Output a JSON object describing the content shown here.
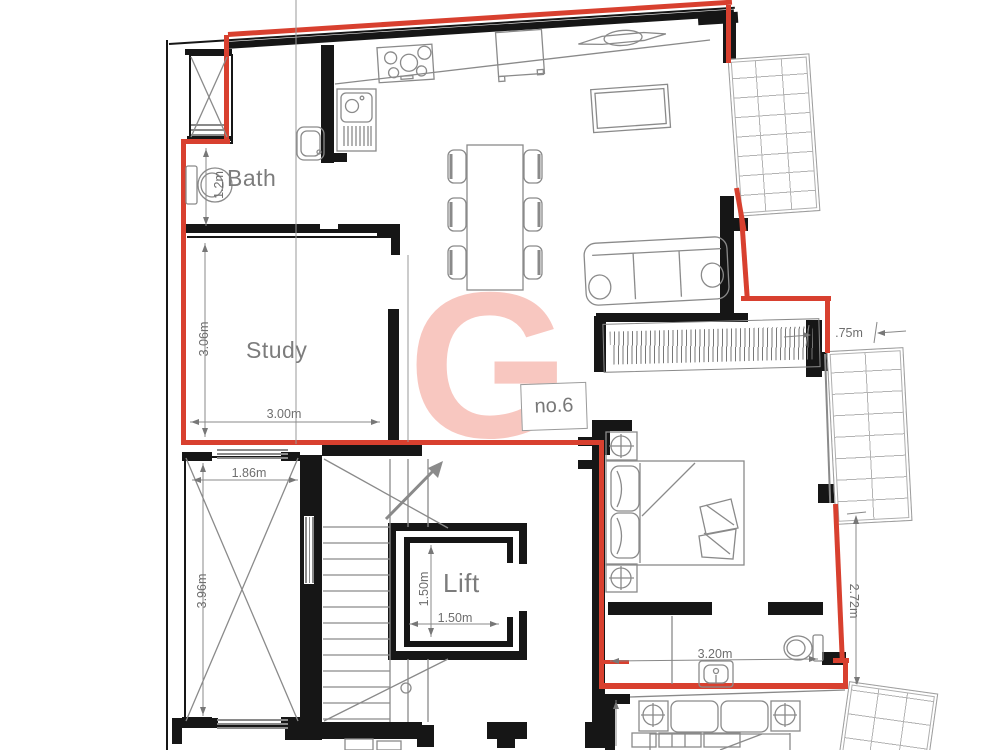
{
  "document": {
    "type": "architectural-floor-plan",
    "unit": "no.6"
  },
  "labels": {
    "bath": "Bath",
    "study": "Study",
    "lift": "Lift",
    "unit_box": "no.6",
    "watermark": "G"
  },
  "dimensions": {
    "study_height": "3.06m",
    "study_width": "3.00m",
    "bath_toilet": "1.2m",
    "shaft_width": "1.86m",
    "shaft_height": "3.96m",
    "lift_depth": "1.50m",
    "lift_width": "1.50m",
    "balcony_offset": ".75m",
    "bedroom_height": "2.72m",
    "ensuite_width": "3.20m"
  },
  "colors": {
    "wall_black": "#161616",
    "line_gray": "#8a8a8a",
    "boundary_red": "#d8402f",
    "watermark_pink": "#f8c7c0",
    "dim_gray": "#6e6e6e",
    "label_gray": "#7c7c7c"
  }
}
